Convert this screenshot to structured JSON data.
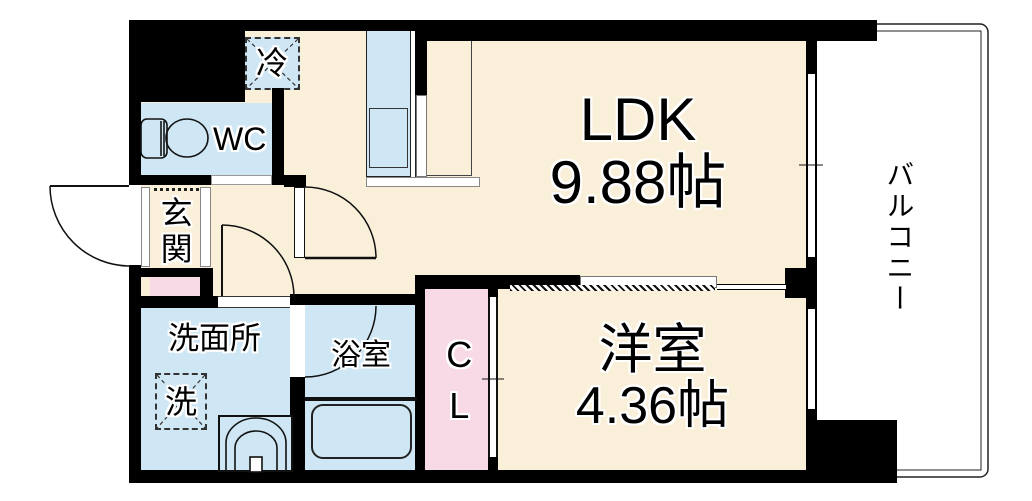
{
  "plan": {
    "rooms": {
      "ldk": {
        "label": "LDK",
        "size": "9.88帖"
      },
      "western": {
        "label": "洋室",
        "size": "4.36帖"
      },
      "balcony": {
        "label": "バルコニー"
      },
      "wc": {
        "label": "WC"
      },
      "entrance": {
        "label": "玄関"
      },
      "washroom": {
        "label": "洗面所"
      },
      "bathroom": {
        "label": "浴室"
      },
      "closet": {
        "label": "CL"
      },
      "refrigerator": {
        "label": "冷"
      },
      "washer": {
        "label": "洗"
      }
    },
    "colors": {
      "floor": "#faf0da",
      "wet_area": "#cfe7f4",
      "closet_pink": "#f8dae6",
      "wall": "#000000",
      "background": "#ffffff"
    }
  }
}
